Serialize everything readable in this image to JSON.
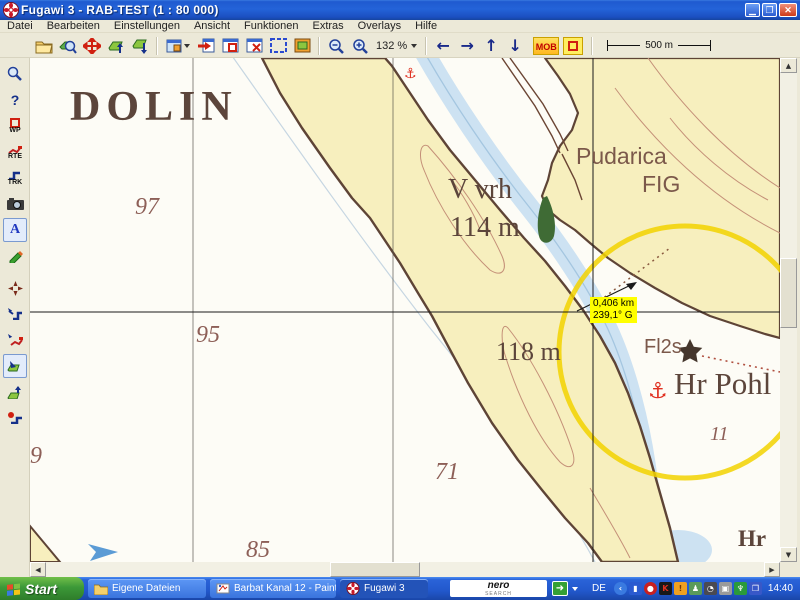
{
  "window": {
    "title": "Fugawi 3 - RAB-TEST  (1 : 80 000)"
  },
  "menu": {
    "items": [
      "Datei",
      "Bearbeiten",
      "Einstellungen",
      "Ansicht",
      "Funktionen",
      "Extras",
      "Overlays",
      "Hilfe"
    ]
  },
  "toolbar": {
    "zoom_level": "132 %",
    "mob_label": "MOB",
    "scale_label": "500 m",
    "arrow_left": "←",
    "arrow_right": "→",
    "arrow_up": "↑",
    "arrow_down": "↓"
  },
  "sidebar": {
    "help_label": "?",
    "wp_label": "WP",
    "rte_label": "RTE",
    "trk_label": "TRK",
    "annotate_label": "A"
  },
  "map": {
    "labels": {
      "region": "DOLIN",
      "depth_97": "97",
      "depth_95": "95",
      "depth_71": "71",
      "depth_85": "85",
      "depth_9": "9",
      "depth_11": "11",
      "peak_name": "V vrh",
      "peak_elev": "114 m",
      "elev_118": "118 m",
      "place_pudarica": "Pudarica",
      "place_fig": "FIG",
      "light_char": "Fl2s",
      "harbor": "Hr Pohl",
      "harbor_small": "Hr"
    },
    "measure_tooltip": {
      "distance": "0,406 km",
      "bearing": "239,1° G"
    }
  },
  "taskbar": {
    "start_label": "Start",
    "tasks": [
      {
        "label": "Eigene Dateien"
      },
      {
        "label": "Barbat Kanal 12 - Paint"
      },
      {
        "label": "Fugawi 3"
      }
    ],
    "nero_line1": "nero",
    "nero_line2": "SEARCH",
    "language": "DE",
    "clock": "14:40"
  },
  "colors": {
    "land": "#f7efbe",
    "coast": "#5e4436",
    "channel": "#cde2f2",
    "contour": "#c49078",
    "range-ring": "#f2d200",
    "tooltip-bg": "#ffff00",
    "taskbar-blue": "#2258cc",
    "start-green": "#3c9838"
  }
}
